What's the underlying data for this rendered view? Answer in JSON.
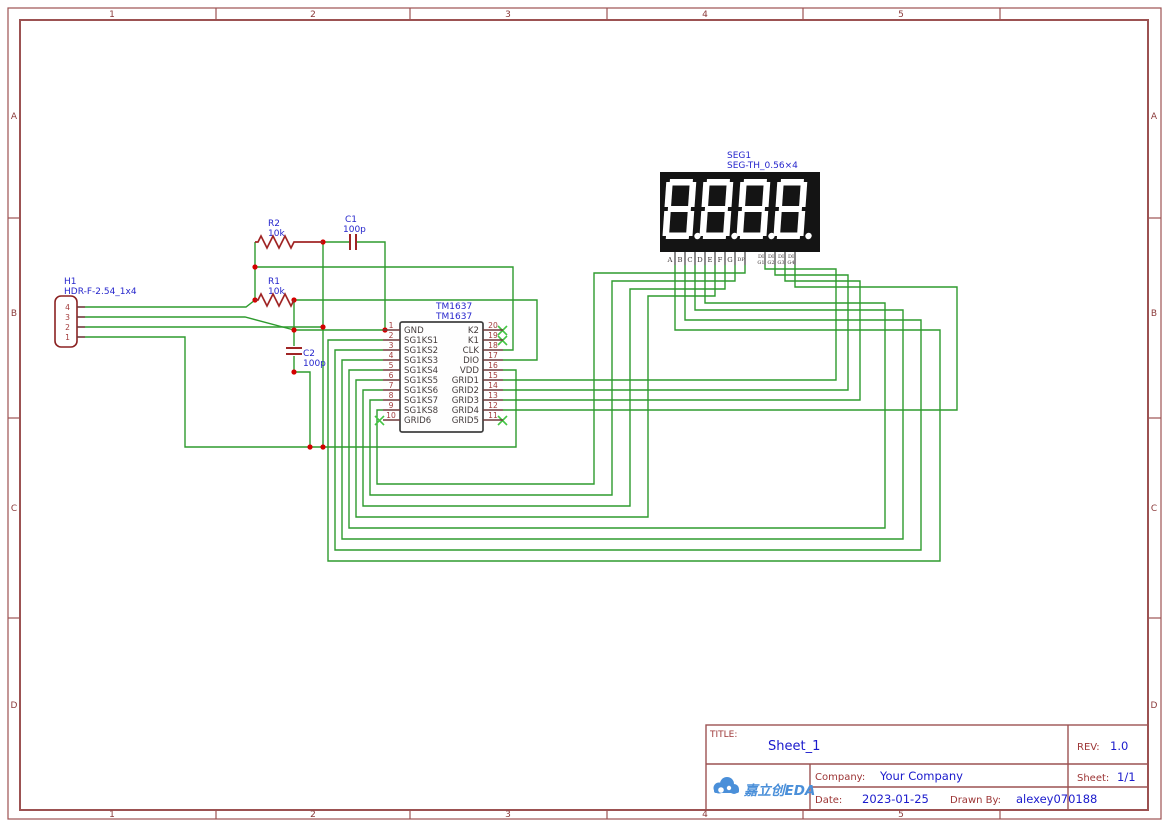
{
  "border": {
    "cols": [
      "1",
      "2",
      "3",
      "4",
      "5"
    ],
    "rows": [
      "A",
      "B",
      "C",
      "D"
    ]
  },
  "colors": {
    "frame": "#9c5252",
    "wire": "#2e9b2e",
    "component": "#8b2222",
    "label_blue": "#2626cc",
    "junction": "#d40000",
    "no_connect": "#44c544",
    "display_body": "#141414",
    "logo_blue": "#4a8fd9"
  },
  "header": {
    "ref": "H1",
    "value": "HDR-F-2.54_1x4",
    "pins": [
      "4",
      "3",
      "2",
      "1"
    ]
  },
  "resistors": [
    {
      "ref": "R2",
      "value": "10k"
    },
    {
      "ref": "R1",
      "value": "10k"
    }
  ],
  "capacitors": [
    {
      "ref": "C1",
      "value": "100p"
    },
    {
      "ref": "C2",
      "value": "100p"
    }
  ],
  "ic": {
    "ref": "TM1637",
    "value": "TM1637",
    "left_pins": [
      {
        "num": "1",
        "name": "GND"
      },
      {
        "num": "2",
        "name": "SG1KS1"
      },
      {
        "num": "3",
        "name": "SG1KS2"
      },
      {
        "num": "4",
        "name": "SG1KS3"
      },
      {
        "num": "5",
        "name": "SG1KS4"
      },
      {
        "num": "6",
        "name": "SG1KS5"
      },
      {
        "num": "7",
        "name": "SG1KS6"
      },
      {
        "num": "8",
        "name": "SG1KS7"
      },
      {
        "num": "9",
        "name": "SG1KS8"
      },
      {
        "num": "10",
        "name": "GRID6"
      }
    ],
    "right_pins": [
      {
        "num": "20",
        "name": "K2"
      },
      {
        "num": "19",
        "name": "K1"
      },
      {
        "num": "18",
        "name": "CLK"
      },
      {
        "num": "17",
        "name": "DIO"
      },
      {
        "num": "16",
        "name": "VDD"
      },
      {
        "num": "15",
        "name": "GRID1"
      },
      {
        "num": "14",
        "name": "GRID2"
      },
      {
        "num": "13",
        "name": "GRID3"
      },
      {
        "num": "12",
        "name": "GRID4"
      },
      {
        "num": "11",
        "name": "GRID5"
      }
    ]
  },
  "display": {
    "ref": "SEG1",
    "value": "SEG-TH_0.56×4",
    "seg_labels": [
      "A",
      "B",
      "C",
      "D",
      "E",
      "F",
      "G",
      "DP"
    ],
    "dig_labels": [
      [
        "DI",
        "G1"
      ],
      [
        "DI",
        "G2"
      ],
      [
        "DI",
        "G3"
      ],
      [
        "DI",
        "G4"
      ]
    ]
  },
  "title_block": {
    "title_label": "TITLE:",
    "title": "Sheet_1",
    "rev_label": "REV:",
    "rev": "1.0",
    "company_label": "Company:",
    "company": "Your Company",
    "sheet_label": "Sheet:",
    "sheet": "1/1",
    "date_label": "Date:",
    "date": "2023-01-25",
    "drawn_by_label": "Drawn By:",
    "drawn_by": "alexey070188",
    "logo_text": "嘉立创EDA"
  }
}
